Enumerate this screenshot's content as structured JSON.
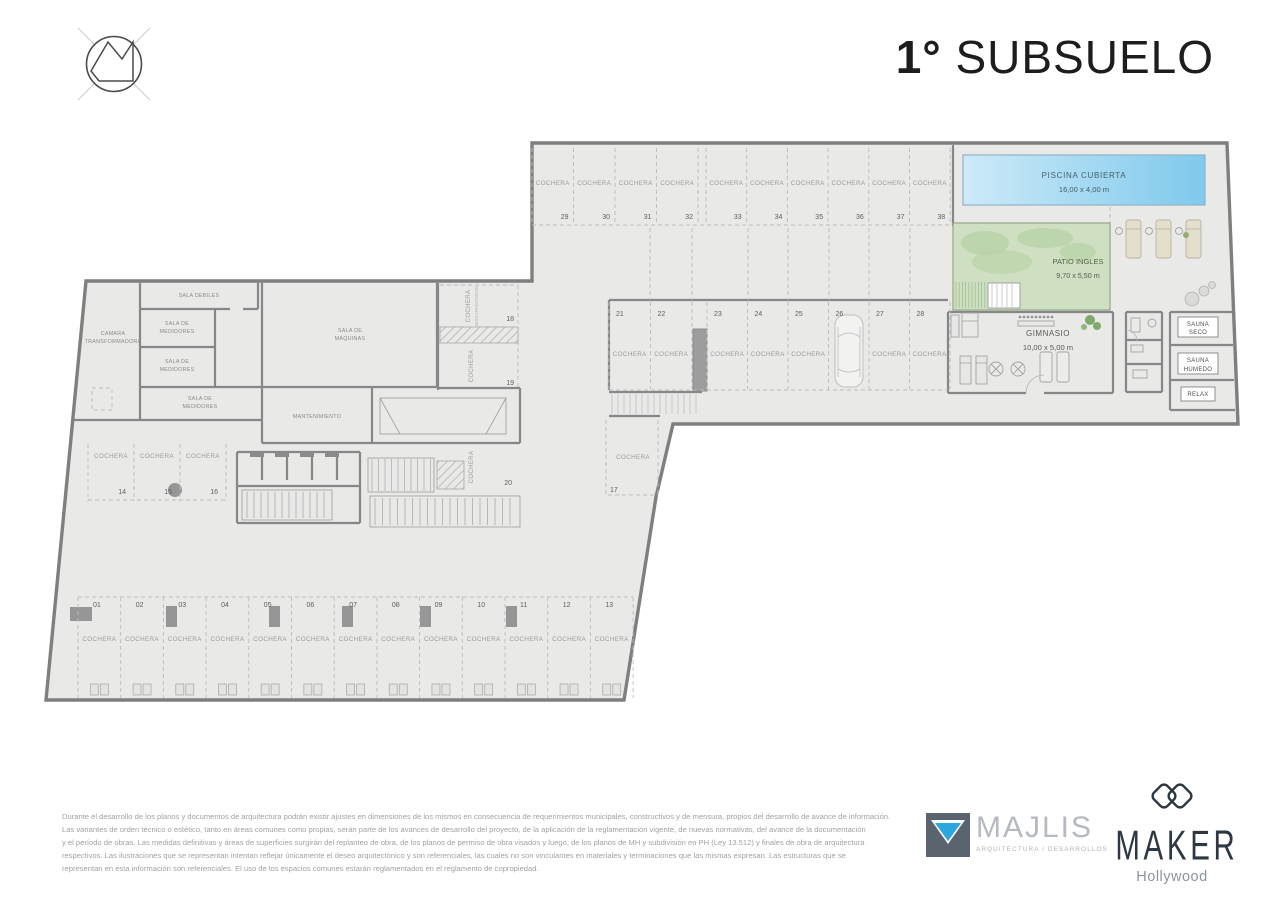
{
  "header": {
    "title_prefix": "1°",
    "title_rest": "SUBSUELO"
  },
  "plan": {
    "stall_word": "COCHERA",
    "accessible": [
      "COCHERA",
      "DISCAPACITADOS"
    ],
    "areas": {
      "pool": {
        "name": "PISCINA CUBIERTA",
        "dims": "16,00 x 4,00 m"
      },
      "patio": {
        "name": "PATIO INGLES",
        "dims": "9,70 x 5,50 m"
      },
      "gym": {
        "name": "GIMNASIO",
        "dims": "10,00 x 5,00 m"
      }
    },
    "rooms": {
      "camara": [
        "CAMARA",
        "TRANSFORMADORA"
      ],
      "sala_debiles": "SALA DEBILES",
      "medidores": [
        "SALA DE",
        "MEDIDORES"
      ],
      "maquinas": [
        "SALA DE",
        "MÁQUINAS"
      ],
      "mantenimiento": "MANTENIMIENTO",
      "sauna_seco": [
        "SAUNA",
        "SECO"
      ],
      "sauna_humedo": [
        "SAUNA",
        "HUMEDO"
      ],
      "relax": "RELAX"
    },
    "rows": {
      "top": [
        "29",
        "30",
        "31",
        "32",
        "33",
        "34",
        "35",
        "36",
        "37",
        "38"
      ],
      "middle": [
        "21",
        "22",
        "23",
        "24",
        "25",
        "26",
        "27",
        "28"
      ],
      "side": [
        "14",
        "15",
        "16"
      ],
      "bottom": [
        "01",
        "02",
        "03",
        "04",
        "05",
        "06",
        "07",
        "08",
        "09",
        "10",
        "11",
        "12",
        "13"
      ]
    },
    "stalls": {
      "s17": "17",
      "s18": "18",
      "s19": "19",
      "s20": "20"
    }
  },
  "footer": {
    "disclaimer": [
      "Durante el desarrollo de los planos y documentos de arquitectura podrán existir ajustes en dimensiones de los mismos en consecuencia de requerimientos municipales, constructivos y de mensura, propios del desarrollo de avance de información.",
      "Las variantes de orden técnico o estético, tanto en áreas comunes como propias, serán parte de los avances de desarrollo del proyecto, de la aplicación de la reglamentación vigente, de nuevas normativas,  del avance de la documentación",
      "y el período de obras. Las medidas definitivas y áreas de superficies surgirán del replanteo de obra, de los planos de permiso de obra visados y luego, de los planos de MH y subdivisión en PH (Ley 13.512) y finales de obra de arquitectura",
      "respectivos. Las ilustraciones que se representan intentan reflejar únicamente el deseo arquitectónico y son referenciales, las cuales no son vinculantes en materiales y terminaciones que las mismas expresan. Las estructuras que se",
      "representan en esta información son referenciales. El uso de los espacios comunes estarán reglamentados en el reglamento de copropiedad."
    ],
    "majlis": {
      "name": "MAJLIS",
      "tagline": "ARQUITECTURA / DESARROLLOS"
    },
    "maker": {
      "name": "MAKER",
      "sub": "Hollywood"
    }
  },
  "colors": {
    "pool": "#7fc9ec",
    "patio": "#cfe0c2",
    "wall": "#878787",
    "floor": "#e9e9e8",
    "cyan": "#2ba7dd"
  }
}
